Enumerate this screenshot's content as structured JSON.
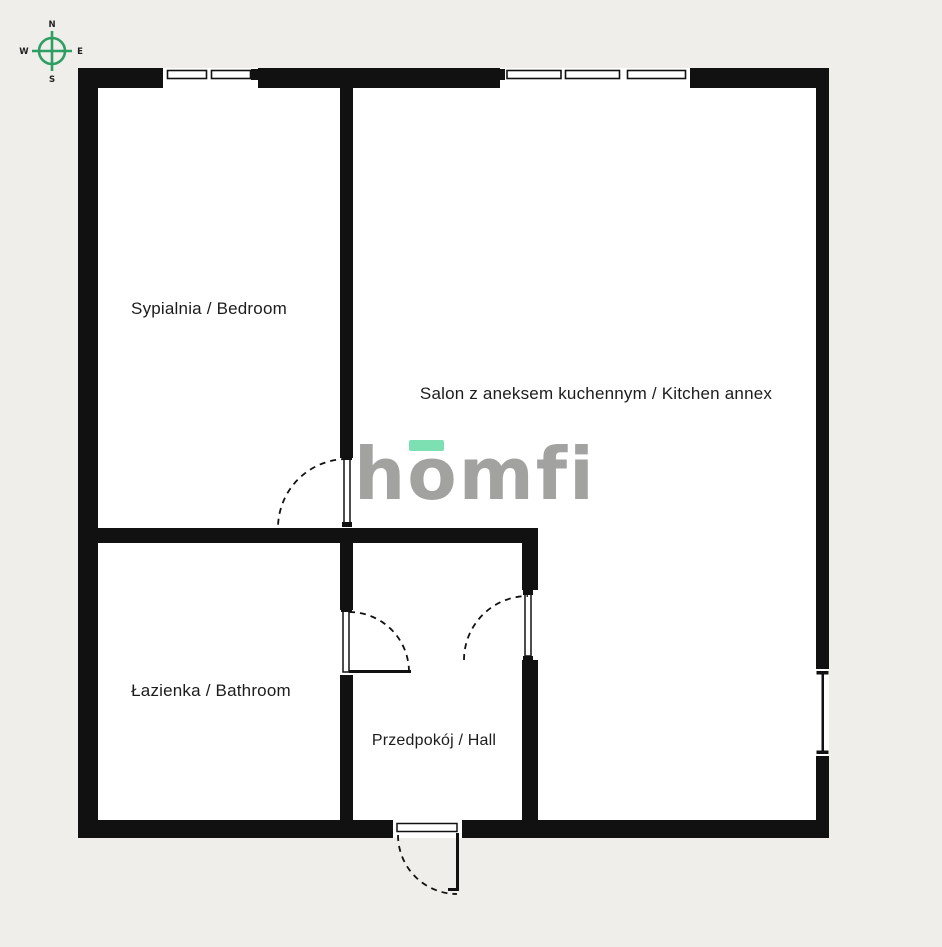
{
  "colors": {
    "background": "#efeeea",
    "floor": "#ffffff",
    "wall": "#111111",
    "compass_green": "#2f9e63",
    "logo_gray": "#a2a2a0",
    "logo_mint": "#7ce0b3",
    "label_text": "#1c1c1c"
  },
  "compass": {
    "north": "N",
    "east": "E",
    "south": "S",
    "west": "W"
  },
  "logo": {
    "text": "homfi"
  },
  "rooms": [
    {
      "id": "bedroom",
      "label": "Sypialnia / Bedroom"
    },
    {
      "id": "living-kitchen",
      "label": "Salon z aneksem kuchennym / Kitchen annex"
    },
    {
      "id": "bathroom",
      "label": "Łazienka / Bathroom"
    },
    {
      "id": "hall",
      "label": "Przedpokój / Hall"
    }
  ]
}
